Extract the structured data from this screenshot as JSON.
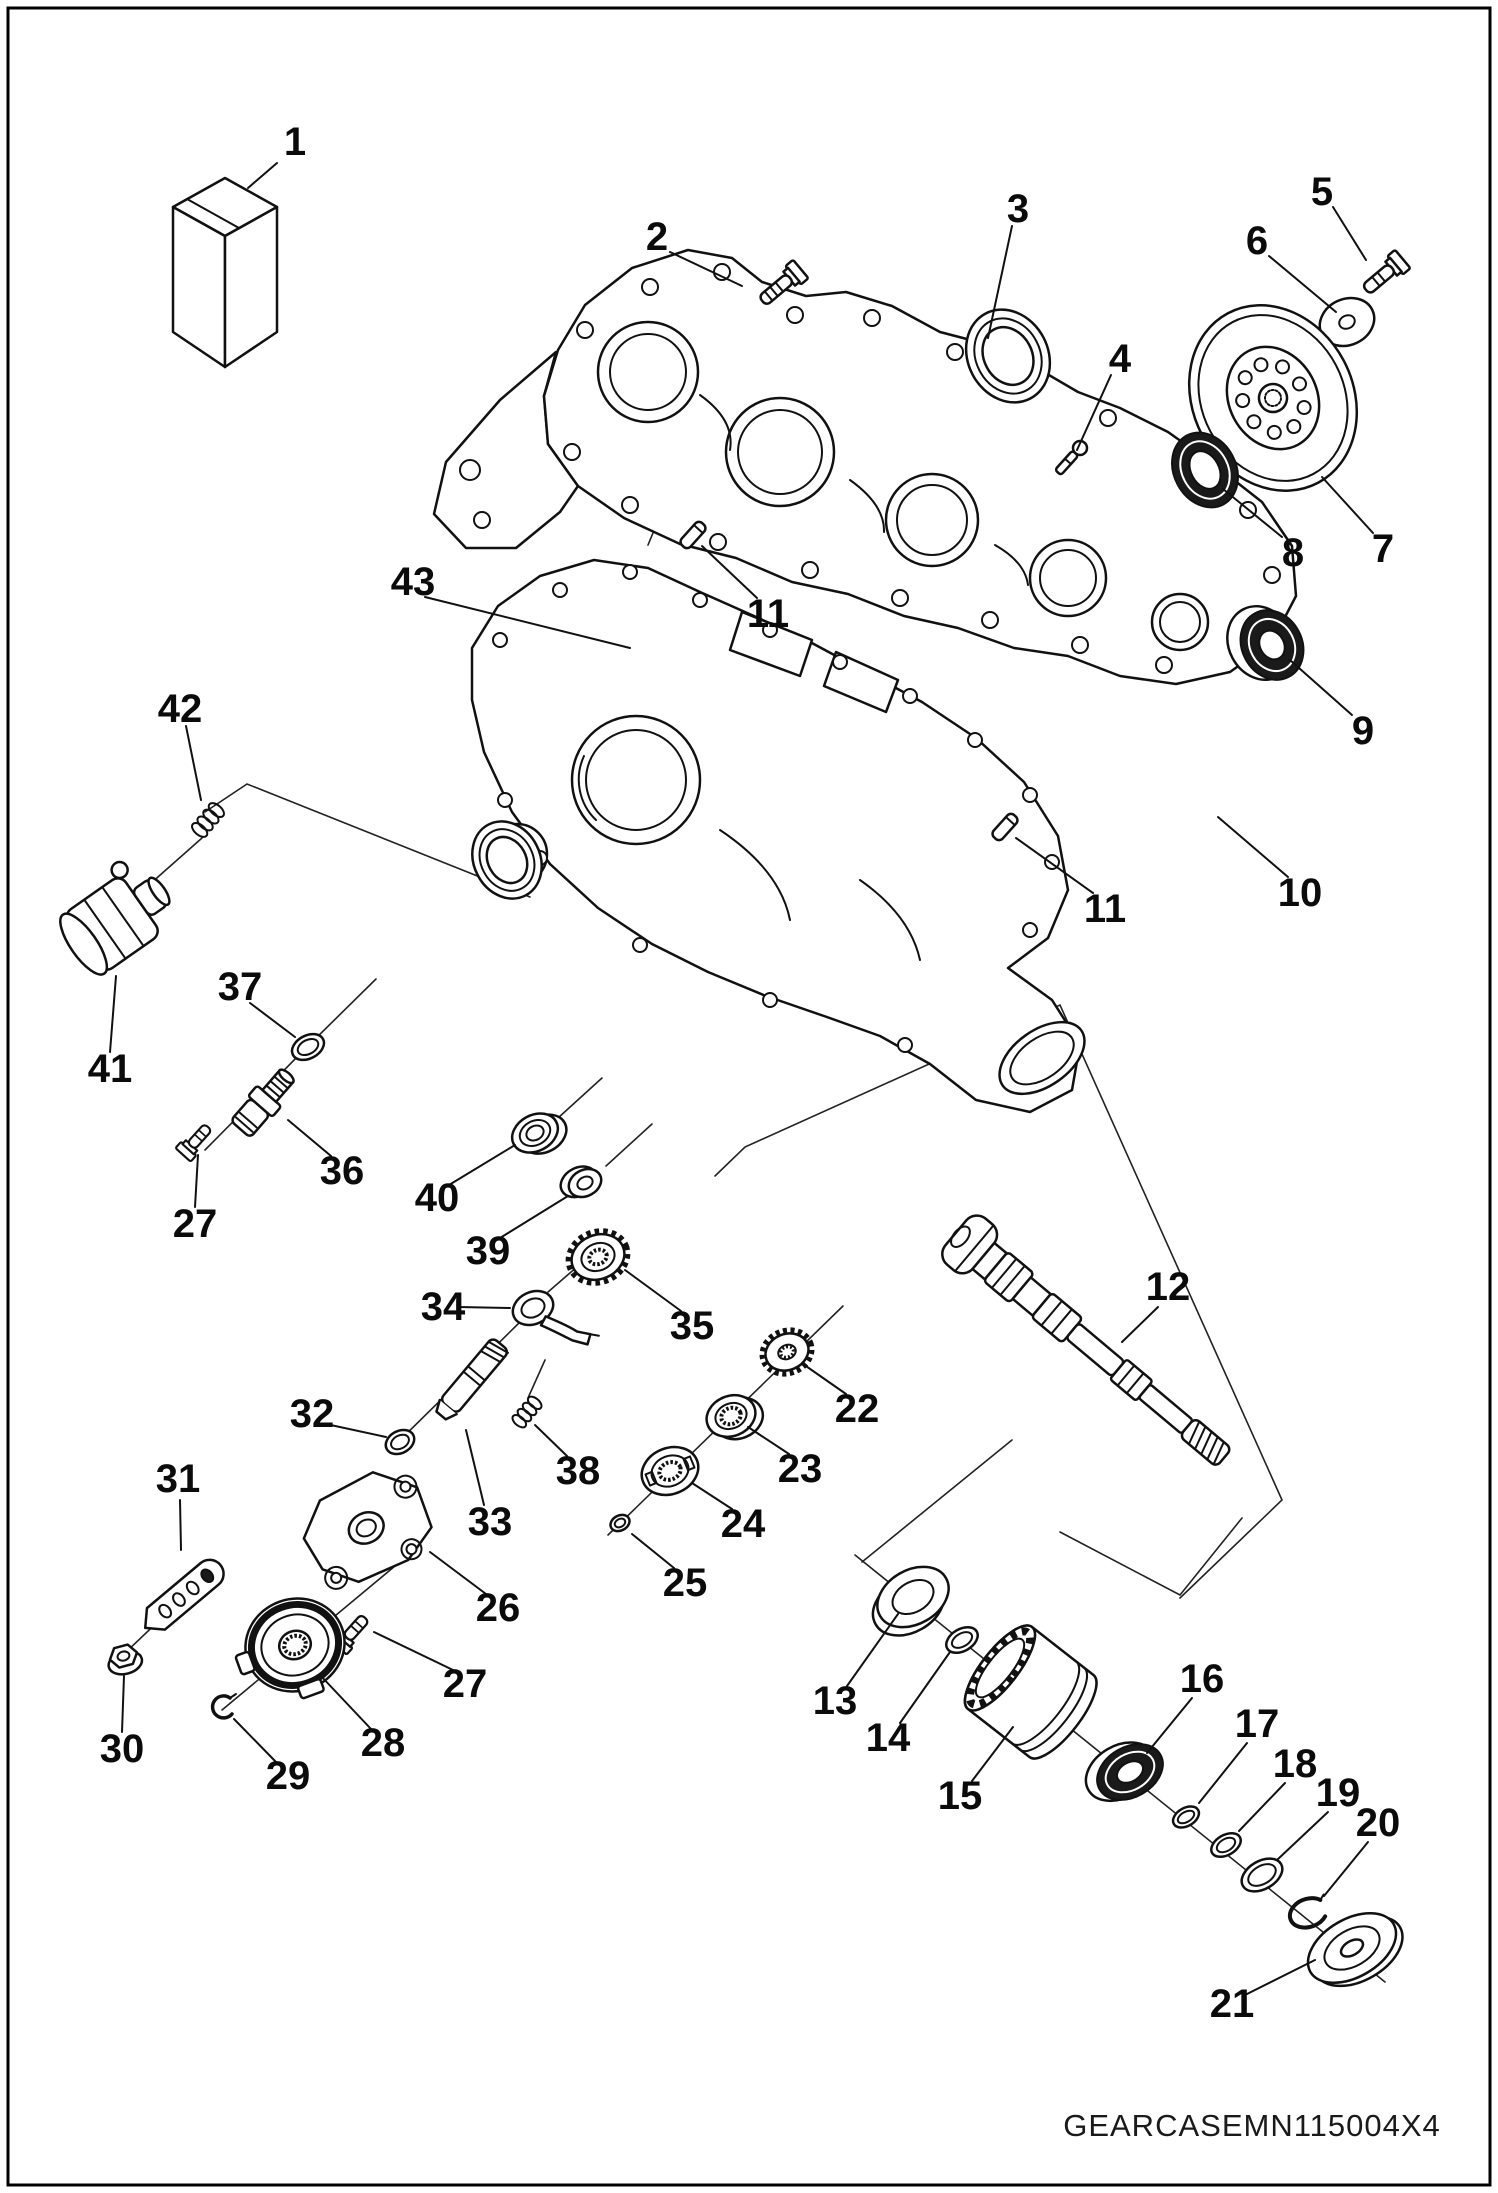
{
  "page": {
    "footer_code": "GEARCASEMN115004X4"
  },
  "colors": {
    "ink": "#111111",
    "paper": "#ffffff"
  },
  "callouts": [
    {
      "label": "1"
    },
    {
      "label": "2"
    },
    {
      "label": "3"
    },
    {
      "label": "4"
    },
    {
      "label": "5"
    },
    {
      "label": "6"
    },
    {
      "label": "7"
    },
    {
      "label": "8"
    },
    {
      "label": "9"
    },
    {
      "label": "10"
    },
    {
      "label": "11"
    },
    {
      "label": "11"
    },
    {
      "label": "12"
    },
    {
      "label": "13"
    },
    {
      "label": "14"
    },
    {
      "label": "15"
    },
    {
      "label": "16"
    },
    {
      "label": "17"
    },
    {
      "label": "18"
    },
    {
      "label": "19"
    },
    {
      "label": "20"
    },
    {
      "label": "21"
    },
    {
      "label": "22"
    },
    {
      "label": "23"
    },
    {
      "label": "24"
    },
    {
      "label": "25"
    },
    {
      "label": "26"
    },
    {
      "label": "27"
    },
    {
      "label": "27"
    },
    {
      "label": "28"
    },
    {
      "label": "29"
    },
    {
      "label": "30"
    },
    {
      "label": "31"
    },
    {
      "label": "32"
    },
    {
      "label": "33"
    },
    {
      "label": "34"
    },
    {
      "label": "35"
    },
    {
      "label": "36"
    },
    {
      "label": "37"
    },
    {
      "label": "38"
    },
    {
      "label": "39"
    },
    {
      "label": "40"
    },
    {
      "label": "41"
    },
    {
      "label": "42"
    },
    {
      "label": "43"
    }
  ]
}
